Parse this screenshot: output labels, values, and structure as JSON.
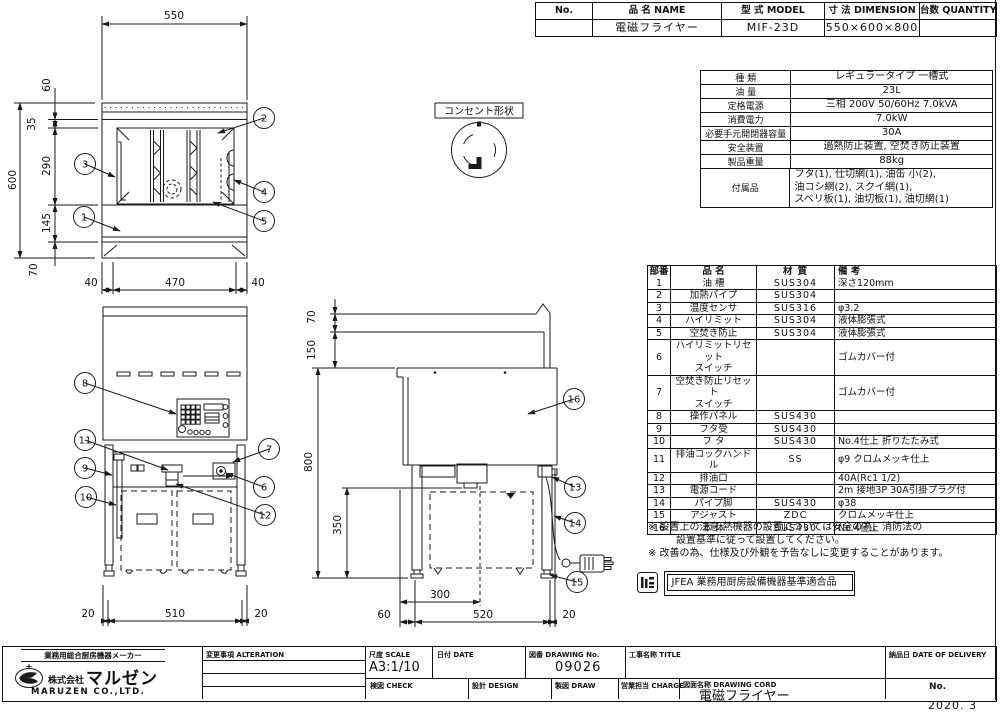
{
  "header_table": {
    "columns": [
      "No.",
      "品 名 NAME",
      "型 式 MODEL",
      "寸 法 DIMENSION",
      "台数 QUANTITY"
    ],
    "no": "",
    "name": "電磁フライヤー",
    "model": "MIF-23D",
    "dimension": "550×600×800",
    "quantity": ""
  },
  "spec_table": {
    "rows": [
      {
        "label": "種  類",
        "value": "レギュラータイプ 一槽式"
      },
      {
        "label": "油  量",
        "value": "23L"
      },
      {
        "label": "定格電源",
        "value": "三相 200V 50/60Hz 7.0kVA"
      },
      {
        "label": "消費電力",
        "value": "7.0kW"
      },
      {
        "label": "必要手元開閉器容量",
        "value": "30A"
      },
      {
        "label": "安全装置",
        "value": "過熱防止装置, 空焚き防止装置"
      },
      {
        "label": "製品重量",
        "value": "88kg"
      },
      {
        "label": "付属品",
        "value": "フタ(1), 仕切網(1), 油缶 小(2),\n油コシ網(2), スクイ網(1),\nスベリ板(1), 油切板(1), 油切網(1)"
      }
    ]
  },
  "parts_table": {
    "columns": [
      "部番",
      "品  名",
      "材  質",
      "備  考"
    ],
    "rows": [
      {
        "no": "1",
        "name": "油 槽",
        "material": "SUS304",
        "note": "深さ120mm"
      },
      {
        "no": "2",
        "name": "加熱パイプ",
        "material": "SUS304",
        "note": ""
      },
      {
        "no": "3",
        "name": "温度センサ",
        "material": "SUS316",
        "note": "φ3.2"
      },
      {
        "no": "4",
        "name": "ハイリミット",
        "material": "SUS304",
        "note": "液体膨張式"
      },
      {
        "no": "5",
        "name": "空焚き防止",
        "material": "SUS304",
        "note": "液体膨張式"
      },
      {
        "no": "6",
        "name": "ハイリミットリセット\nスイッチ",
        "material": "",
        "note": "ゴムカバー付"
      },
      {
        "no": "7",
        "name": "空焚き防止リセット\nスイッチ",
        "material": "",
        "note": "ゴムカバー付"
      },
      {
        "no": "8",
        "name": "操作パネル",
        "material": "SUS430",
        "note": ""
      },
      {
        "no": "9",
        "name": "フタ受",
        "material": "SUS430",
        "note": ""
      },
      {
        "no": "10",
        "name": "フ タ",
        "material": "SUS430",
        "note": "No.4仕上 折りたたみ式"
      },
      {
        "no": "11",
        "name": "排油コックハンドル",
        "material": "SS",
        "note": "φ9 クロムメッキ仕上"
      },
      {
        "no": "12",
        "name": "排油口",
        "material": "",
        "note": "40A(Rc1 1/2)"
      },
      {
        "no": "13",
        "name": "電源コード",
        "material": "",
        "note": "2m 接地3P 30A引掛プラグ付"
      },
      {
        "no": "14",
        "name": "パイプ脚",
        "material": "SUS430",
        "note": "φ38"
      },
      {
        "no": "15",
        "name": "アジャスト",
        "material": "ZDC",
        "note": "クロムメッキ仕上"
      },
      {
        "no": "16",
        "name": "本 体",
        "material": "SUS430",
        "note": "No.4仕上"
      }
    ]
  },
  "notes": {
    "line1": "※ 設置上の注意 熱機器の設置については安全の為、消防法の",
    "line2": "設置基準に従って設置してください。",
    "line3": "※ 改善の為、仕様及び外観を予告なしに変更することがあります。"
  },
  "jfea": {
    "label": "JFEA 業務用厨房設備機器基準適合品"
  },
  "drawing": {
    "outlet_label": "コンセント形状",
    "plan": {
      "dim_top": "550",
      "dim_left_total": "600",
      "dim_left_60": "60",
      "dim_left_35": "35",
      "dim_left_290": "290",
      "dim_left_145": "145",
      "dim_left_70": "70",
      "dim_bottom_left": "40",
      "dim_bottom_center": "470",
      "dim_bottom_right": "40",
      "callout_1": "1",
      "callout_2": "2",
      "callout_3": "3",
      "callout_4": "4",
      "callout_5": "5"
    },
    "front": {
      "dim_bottom_left": "20",
      "dim_bottom_center": "510",
      "dim_bottom_right": "20",
      "callout_6": "6",
      "callout_7": "7",
      "callout_8": "8",
      "callout_9": "9",
      "callout_10": "10",
      "callout_11": "11",
      "callout_12": "12"
    },
    "side": {
      "dim_70": "70",
      "dim_150": "150",
      "dim_800": "800",
      "dim_350": "350",
      "dim_bottom_60": "60",
      "dim_bottom_300": "300",
      "dim_bottom_520": "520",
      "dim_bottom_20": "20",
      "callout_13": "13",
      "callout_14": "14",
      "callout_15": "15",
      "callout_16": "16"
    }
  },
  "title_block": {
    "alteration_label": "変更事項 ALTERATION",
    "scale_label": "尺度 SCALE",
    "scale_value": "A3:1/10",
    "date_label": "日付 DATE",
    "drawing_no_label": "図番 DRAWING No.",
    "drawing_no_value": "09026",
    "title_label": "工事名称 TITLE",
    "delivery_label": "納品日 DATE OF DELIVERY",
    "check_label": "検図 CHECK",
    "design_label": "設計 DESIGN",
    "draw_label": "製図 DRAW",
    "charge_label": "営業担当 CHARGE",
    "drawing_cord_label": "図面名称 DRAWING CORD",
    "drawing_cord_value": "電磁フライヤー",
    "no_label": "No.",
    "date_bottom": "2020. 3"
  },
  "company": {
    "tagline": "業務用総合厨房機器メーカー",
    "name_prefix": "株式会社",
    "name": "マルゼン",
    "name_en": "MARUZEN CO.,LTD."
  }
}
